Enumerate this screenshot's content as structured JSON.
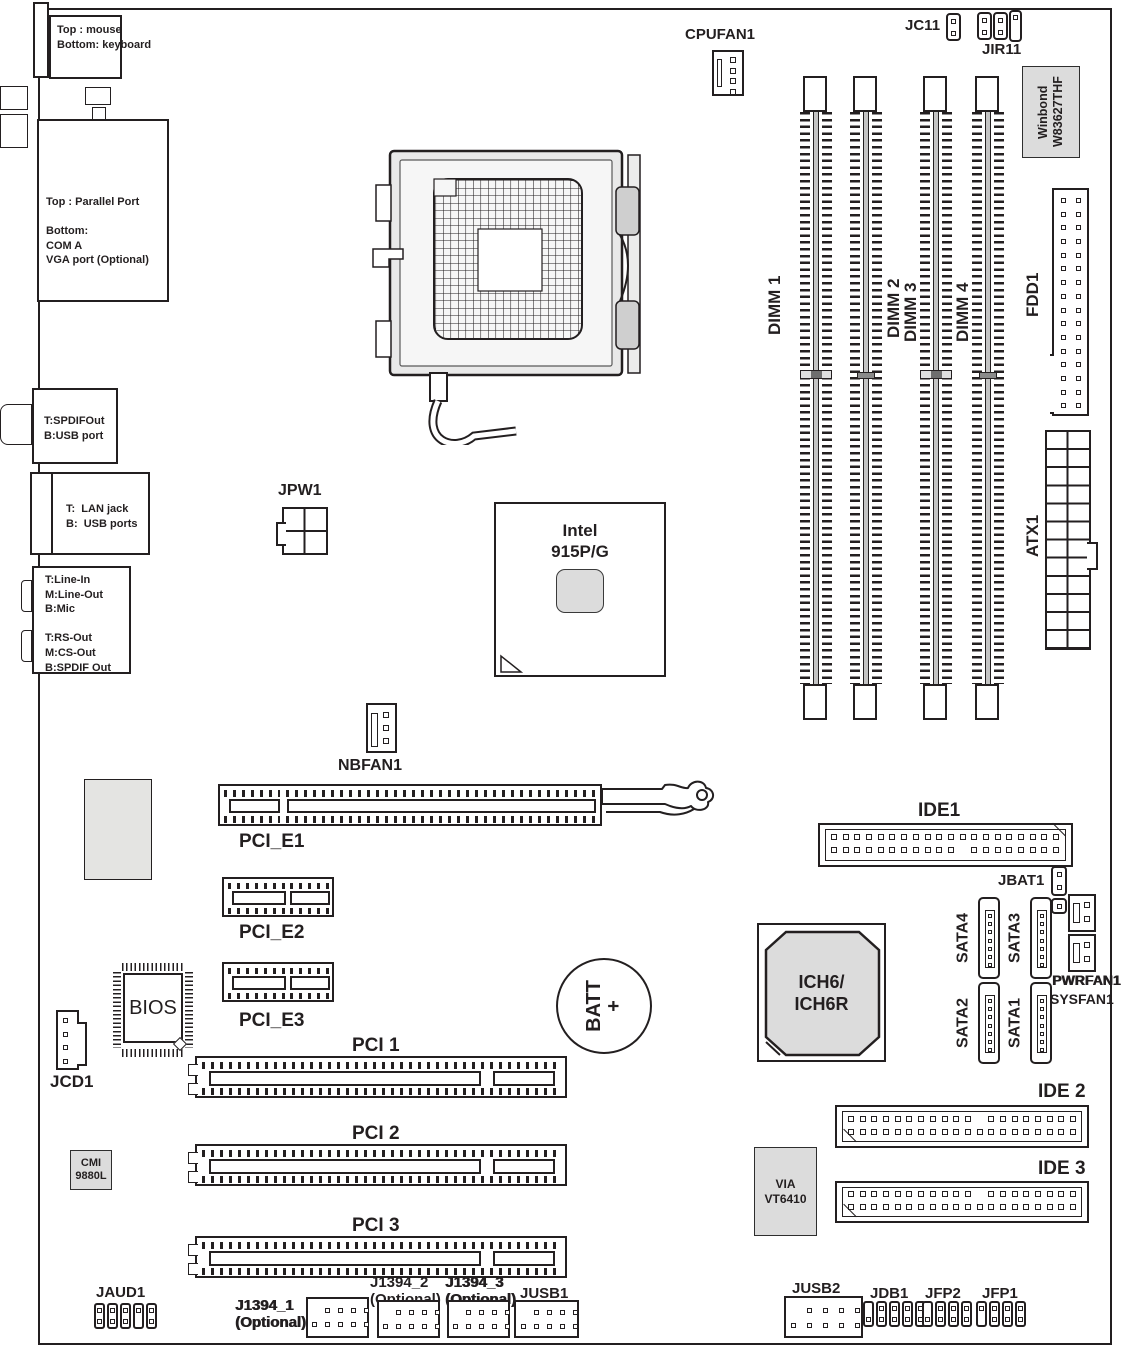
{
  "rear": {
    "kb": "Top : mouse\nBottom: keyboard",
    "parallel": "Top : Parallel Port\n\nBottom:\nCOM A\nVGA port (Optional)",
    "spdif": "T:SPDIFOut\nB:USB port",
    "lan": "T:  LAN jack\nB:  USB ports",
    "audio": "T:Line-In\nM:Line-Out\nB:Mic\n\nT:RS-Out\nM:CS-Out\nB:SPDIF Out"
  },
  "chips": {
    "winbond": "Winbond\nW83627THF",
    "northbridge": "Intel\n915P/G",
    "southbridge": "ICH6/\nICH6R",
    "bios": "BIOS",
    "cmi": "CMI\n9880L",
    "via": "VIA\nVT6410"
  },
  "c": {
    "cpufan": "CPUFAN1",
    "jc11": "JC11",
    "jir11": "JIR11",
    "dimm1": "DIMM 1",
    "dimm2": "DIMM 2",
    "dimm3": "DIMM 3",
    "dimm4": "DIMM 4",
    "fdd": "FDD1",
    "atx": "ATX1",
    "jpw": "JPW1",
    "nbfan": "NBFAN1",
    "pcie1": "PCI_E1",
    "pcie2": "PCI_E2",
    "pcie3": "PCI_E3",
    "jcd": "JCD1",
    "pci1": "PCI 1",
    "pci2": "PCI 2",
    "pci3": "PCI 3",
    "batt": "BATT\n+",
    "ide1": "IDE1",
    "jbat": "JBAT1",
    "sata1": "SATA1",
    "sata2": "SATA2",
    "sata3": "SATA3",
    "sata4": "SATA4",
    "pwrfan": "PWRFAN1",
    "sysfan": "SYSFAN1",
    "ide2": "IDE 2",
    "ide3": "IDE 3",
    "jaud": "JAUD1",
    "j1394_1": "J1394_1\n(Optional)",
    "j1394_2": "J1394_2\n(Optional)",
    "j1394_3": "J1394_3\n(Optional)",
    "jusb1": "JUSB1",
    "jusb2": "JUSB2",
    "jdb1": "JDB1",
    "jfp2": "JFP2",
    "jfp1": "JFP1"
  },
  "colors": {
    "line": "#231f20",
    "chip_fill": "#dcdcdc",
    "socket_fill": "#e9e9e9"
  }
}
